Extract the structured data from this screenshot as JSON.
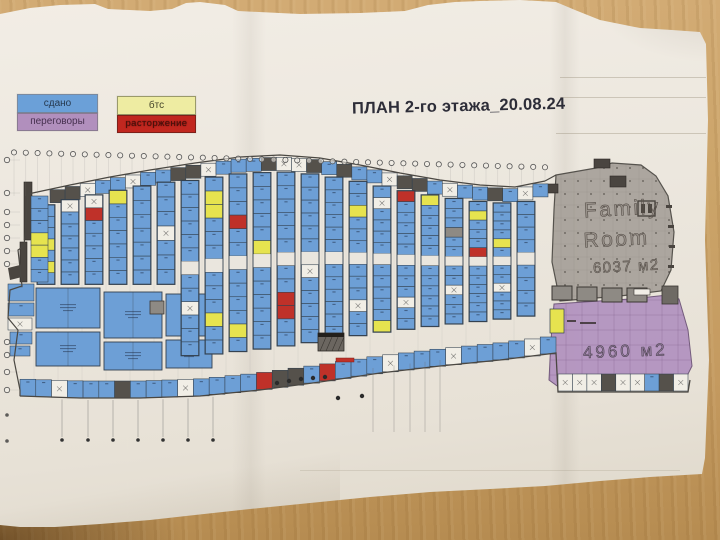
{
  "scene": {
    "wood_color": "#c7a069",
    "paper_color": "#ece7de"
  },
  "title": "ПЛАН 2-го этажа_20.08.24",
  "legend": {
    "items": [
      {
        "id": "rented",
        "label": "сдано",
        "color": "#6ba0d8",
        "border": "#7a8aa0",
        "text": "#26394f"
      },
      {
        "id": "bts",
        "label": "бтс",
        "color": "#eeeca2",
        "border": "#9a9a6a",
        "text": "#45452a"
      },
      {
        "id": "negotiations",
        "label": "переговоры",
        "color": "#b18fbd",
        "border": "#8a7a92",
        "text": "#46304f"
      },
      {
        "id": "termination",
        "label": "расторжение",
        "color": "#c1271f",
        "border": "#7e2019",
        "text": "#45100b"
      }
    ]
  },
  "family_room": {
    "line1": "Family",
    "line2": "Room",
    "area": "6037 м2",
    "fill": "#a7a19a"
  },
  "purple_zone": {
    "area": "4960 м2",
    "fill": "#b394c0"
  },
  "plan": {
    "colors": {
      "B": "#6d9fd6",
      "Y": "#e6e34f",
      "R": "#bf3129",
      "W": "#f1eee6",
      "G": "#8e8a84",
      "D": "#55514b",
      "A": "#eae6de"
    },
    "wall": "#33414f",
    "outline": "#4a4742",
    "top_row_pattern": "DDWBBWBBDDWBBBDWWDBDBBWDDBWBBDBWB",
    "strips": [
      {
        "x": 46,
        "cells": "BBBYBYB"
      },
      {
        "x": 70,
        "cells": "WBBBBBB"
      },
      {
        "x": 94,
        "cells": "WRBBBBB"
      },
      {
        "x": 118,
        "cells": "YBBBBBB"
      },
      {
        "x": 142,
        "cells": "BBBBBBB"
      },
      {
        "x": 166,
        "cells": "BBBWBBB"
      },
      {
        "x": 190,
        "cells": "BBBBBBABBWBBB"
      },
      {
        "x": 214,
        "cells": "BYYBBBABBBYBB"
      },
      {
        "x": 238,
        "cells": "BBBRBBABBBBYB"
      },
      {
        "x": 262,
        "cells": "BBBBBYABBBBBB"
      },
      {
        "x": 286,
        "cells": "BBBBBBABBRRBB"
      },
      {
        "x": 310,
        "cells": "BBBBBBAWBBBBB"
      },
      {
        "x": 334,
        "cells": "BBBBBBABBBBBB"
      },
      {
        "x": 358,
        "cells": "BBYBBBABBBWBB"
      },
      {
        "x": 382,
        "cells": "BWBBBBABBBBBY"
      },
      {
        "x": 406,
        "cells": "RBBBBBABBBWBB"
      },
      {
        "x": 430,
        "cells": "YBBBBBABBBBBB"
      },
      {
        "x": 454,
        "cells": "BBBGBBABBWBBB"
      },
      {
        "x": 478,
        "cells": "BYBBBRABBBBBB"
      },
      {
        "x": 502,
        "cells": "BBBBYBABBWBBB"
      },
      {
        "x": 526,
        "cells": "BBBBABBBB"
      }
    ],
    "outer_row_pattern": "BBWBBBDBBBWBBBBRDDBRBBBWBBBWBBBBWB",
    "right_row_pattern": "WWWDWWBDW",
    "left_column_cells": "BBBYYBB",
    "left_blocks": "BBWBB"
  }
}
